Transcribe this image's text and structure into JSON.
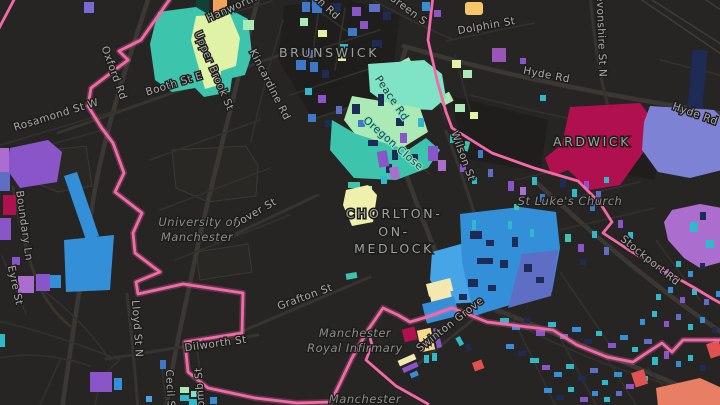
{
  "palette": {
    "bg": "#272523",
    "block": "#1f1e1c",
    "blockLight": "#2a2825",
    "road": "#3b3834",
    "roadMid": "#37342f",
    "roadMinor": "#33312d",
    "railway": "#403d38",
    "outline": "#3b3835",
    "halo": "#1c1b19",
    "boundary": "#f469a7",
    "labelStreet": "#a9a9a7",
    "labelStreetDark": "#2e3c37",
    "labelPlace": "#9ba19d",
    "labelPoi": "#8a8d8a",
    "teal": "#3cc4ad",
    "seafoam": "#7fe4c6",
    "mint": "#abeab5",
    "lime": "#dff2a5",
    "azure": "#3390d8",
    "lightblue": "#45a5e6",
    "blue": "#3e78c9",
    "navy": "#1d2b55",
    "slate": "#5e6ec5",
    "peri": "#7e82d4",
    "violet": "#8a55c8",
    "iris": "#7a6ad4",
    "orchid": "#ac6ece",
    "plum": "#9a55b8",
    "crimson": "#b1104e",
    "red": "#e05150",
    "salmon": "#e87e64",
    "orange": "#f2a35b",
    "amber": "#f6c667",
    "cream": "#f4e8ae",
    "gold": "#f7d98e",
    "paleyellow": "#eef0ac",
    "cyan": "#2fb9c9",
    "darkgreen": "#123f36"
  },
  "labels": {
    "places": [
      {
        "text": "BRUNSWICK",
        "x": 329,
        "y": 57
      },
      {
        "text": "ARDWICK",
        "x": 592,
        "y": 146
      },
      {
        "text": "CHORLTON-",
        "x": 394,
        "y": 218,
        "ls": 4
      },
      {
        "text": "ON-",
        "x": 394,
        "y": 236,
        "ls": 4
      },
      {
        "text": "MEDLOCK",
        "x": 394,
        "y": 253,
        "ls": 4
      }
    ],
    "pois": [
      {
        "text": "University of",
        "x": 198,
        "y": 226
      },
      {
        "text": "Manchester",
        "x": 197,
        "y": 241
      },
      {
        "text": "St Luke's Church",
        "x": 570,
        "y": 205
      },
      {
        "text": "Manchester",
        "x": 355,
        "y": 337
      },
      {
        "text": "Royal Infirmary",
        "x": 355,
        "y": 352
      },
      {
        "text": "Manchester",
        "x": 365,
        "y": 403
      }
    ],
    "streets": [
      {
        "text": "Oxford Rd",
        "x": 111,
        "y": 74,
        "rot": 70
      },
      {
        "text": "Booth St E",
        "x": 175,
        "y": 87,
        "rot": -17
      },
      {
        "text": "Rosamond St W",
        "x": 57,
        "y": 118,
        "rot": -17
      },
      {
        "text": "Upper Brook St",
        "x": 211,
        "y": 72,
        "rot": 67
      },
      {
        "text": "Hanworth",
        "x": 233,
        "y": 11,
        "rot": -24
      },
      {
        "text": "Kincardine Rd",
        "x": 267,
        "y": 86,
        "rot": 63
      },
      {
        "text": "on Rd",
        "x": 324,
        "y": 9,
        "rot": 43
      },
      {
        "text": "Green S",
        "x": 406,
        "y": 12,
        "rot": 37
      },
      {
        "text": "Dolphin St",
        "x": 487,
        "y": 29,
        "rot": -10
      },
      {
        "text": "Peace Rd",
        "x": 389,
        "y": 100,
        "rot": 56,
        "dark": true
      },
      {
        "text": "Oregon Close",
        "x": 391,
        "y": 146,
        "rot": 41,
        "dark": true
      },
      {
        "text": "Devonshire St N",
        "x": 598,
        "y": 32,
        "rot": 88
      },
      {
        "text": "Hyde Rd",
        "x": 546,
        "y": 78,
        "rot": 11
      },
      {
        "text": "Hyde Rd",
        "x": 694,
        "y": 117,
        "rot": 20
      },
      {
        "text": "Wilson St",
        "x": 460,
        "y": 157,
        "rot": 70
      },
      {
        "text": "Stockport Rd",
        "x": 648,
        "y": 263,
        "rot": 39
      },
      {
        "text": "Dover St",
        "x": 256,
        "y": 216,
        "rot": -30
      },
      {
        "text": "Grafton St",
        "x": 306,
        "y": 300,
        "rot": -20
      },
      {
        "text": "Swinton Grove",
        "x": 452,
        "y": 327,
        "rot": -38
      },
      {
        "text": "Dilworth St",
        "x": 216,
        "y": 347,
        "rot": -8
      },
      {
        "text": "Lloyd St N",
        "x": 134,
        "y": 329,
        "rot": 86
      },
      {
        "text": "Boundary Ln",
        "x": 21,
        "y": 226,
        "rot": 82
      },
      {
        "text": "Eyre St",
        "x": 12,
        "y": 286,
        "rot": 78
      },
      {
        "text": "Cecil St",
        "x": 167,
        "y": 391,
        "rot": 87
      },
      {
        "text": "omb St",
        "x": 203,
        "y": 387,
        "rot": -94
      }
    ]
  }
}
